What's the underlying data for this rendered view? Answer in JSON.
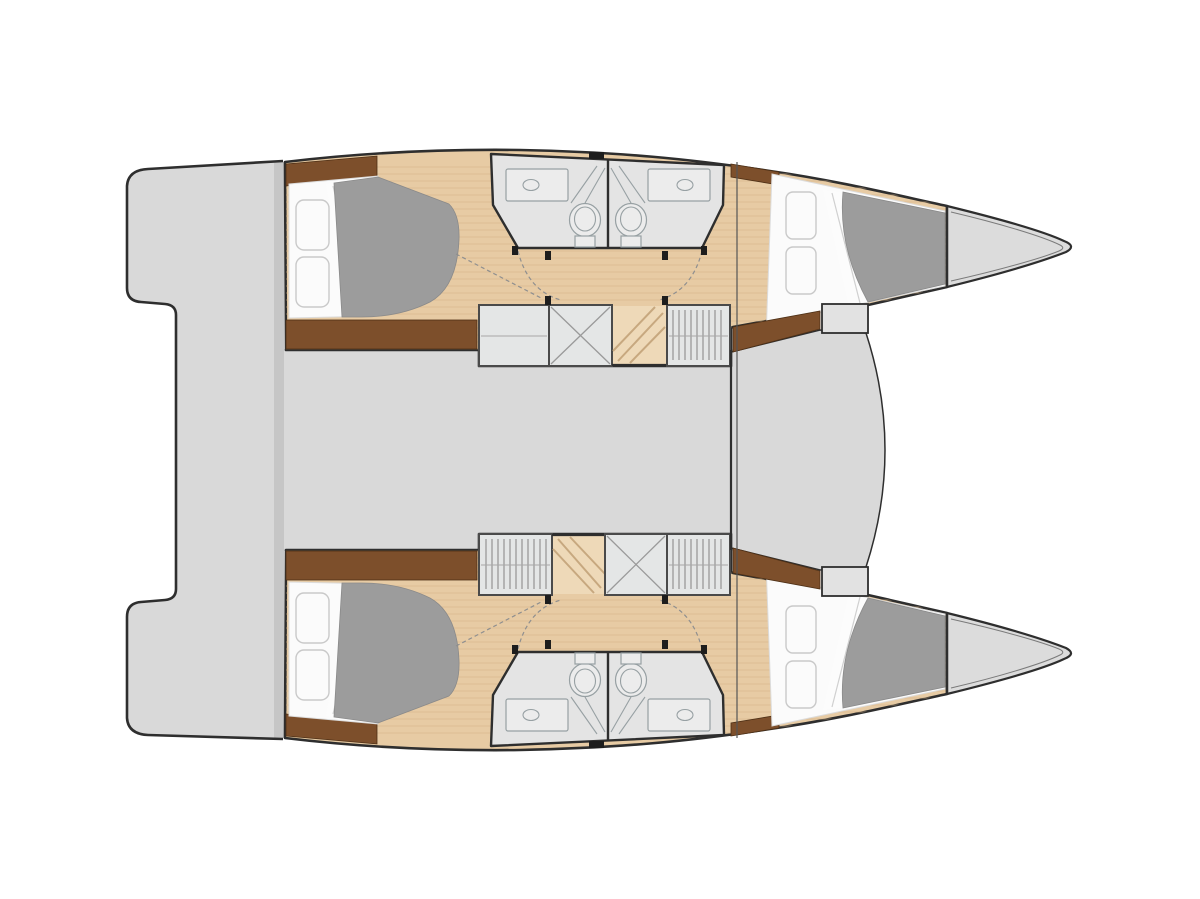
{
  "colors": {
    "background": "#ffffff",
    "outline": "#2e2e2e",
    "deck_gray": "#d9d9d9",
    "deck_band": "#c6c6c6",
    "saloon_gray": "#d9d9d9",
    "foredeck_gray": "#d9d9d9",
    "forepeak_gray": "#dcdcdc",
    "wood_floor": "#e7cba4",
    "wood_plank": "#d3b289",
    "stair_wood": "#eed9b8",
    "stair_line": "#c7a87f",
    "trim_brown": "#7d4f2b",
    "mattress_white": "#fbfbfb",
    "sheet_white": "#fcfcfc",
    "blanket_gray": "#9c9c9c",
    "bathroom_gray": "#e4e4e4",
    "fixture_fill": "#ececec",
    "fixture_line": "#97a0a3",
    "cabinet_fill": "#e4e6e6",
    "cabinet_border": "#4a4a4a",
    "hanger_line": "#9a9a9a",
    "door_dash": "#8f8f8f",
    "hatch_black": "#1d1d1d"
  }
}
